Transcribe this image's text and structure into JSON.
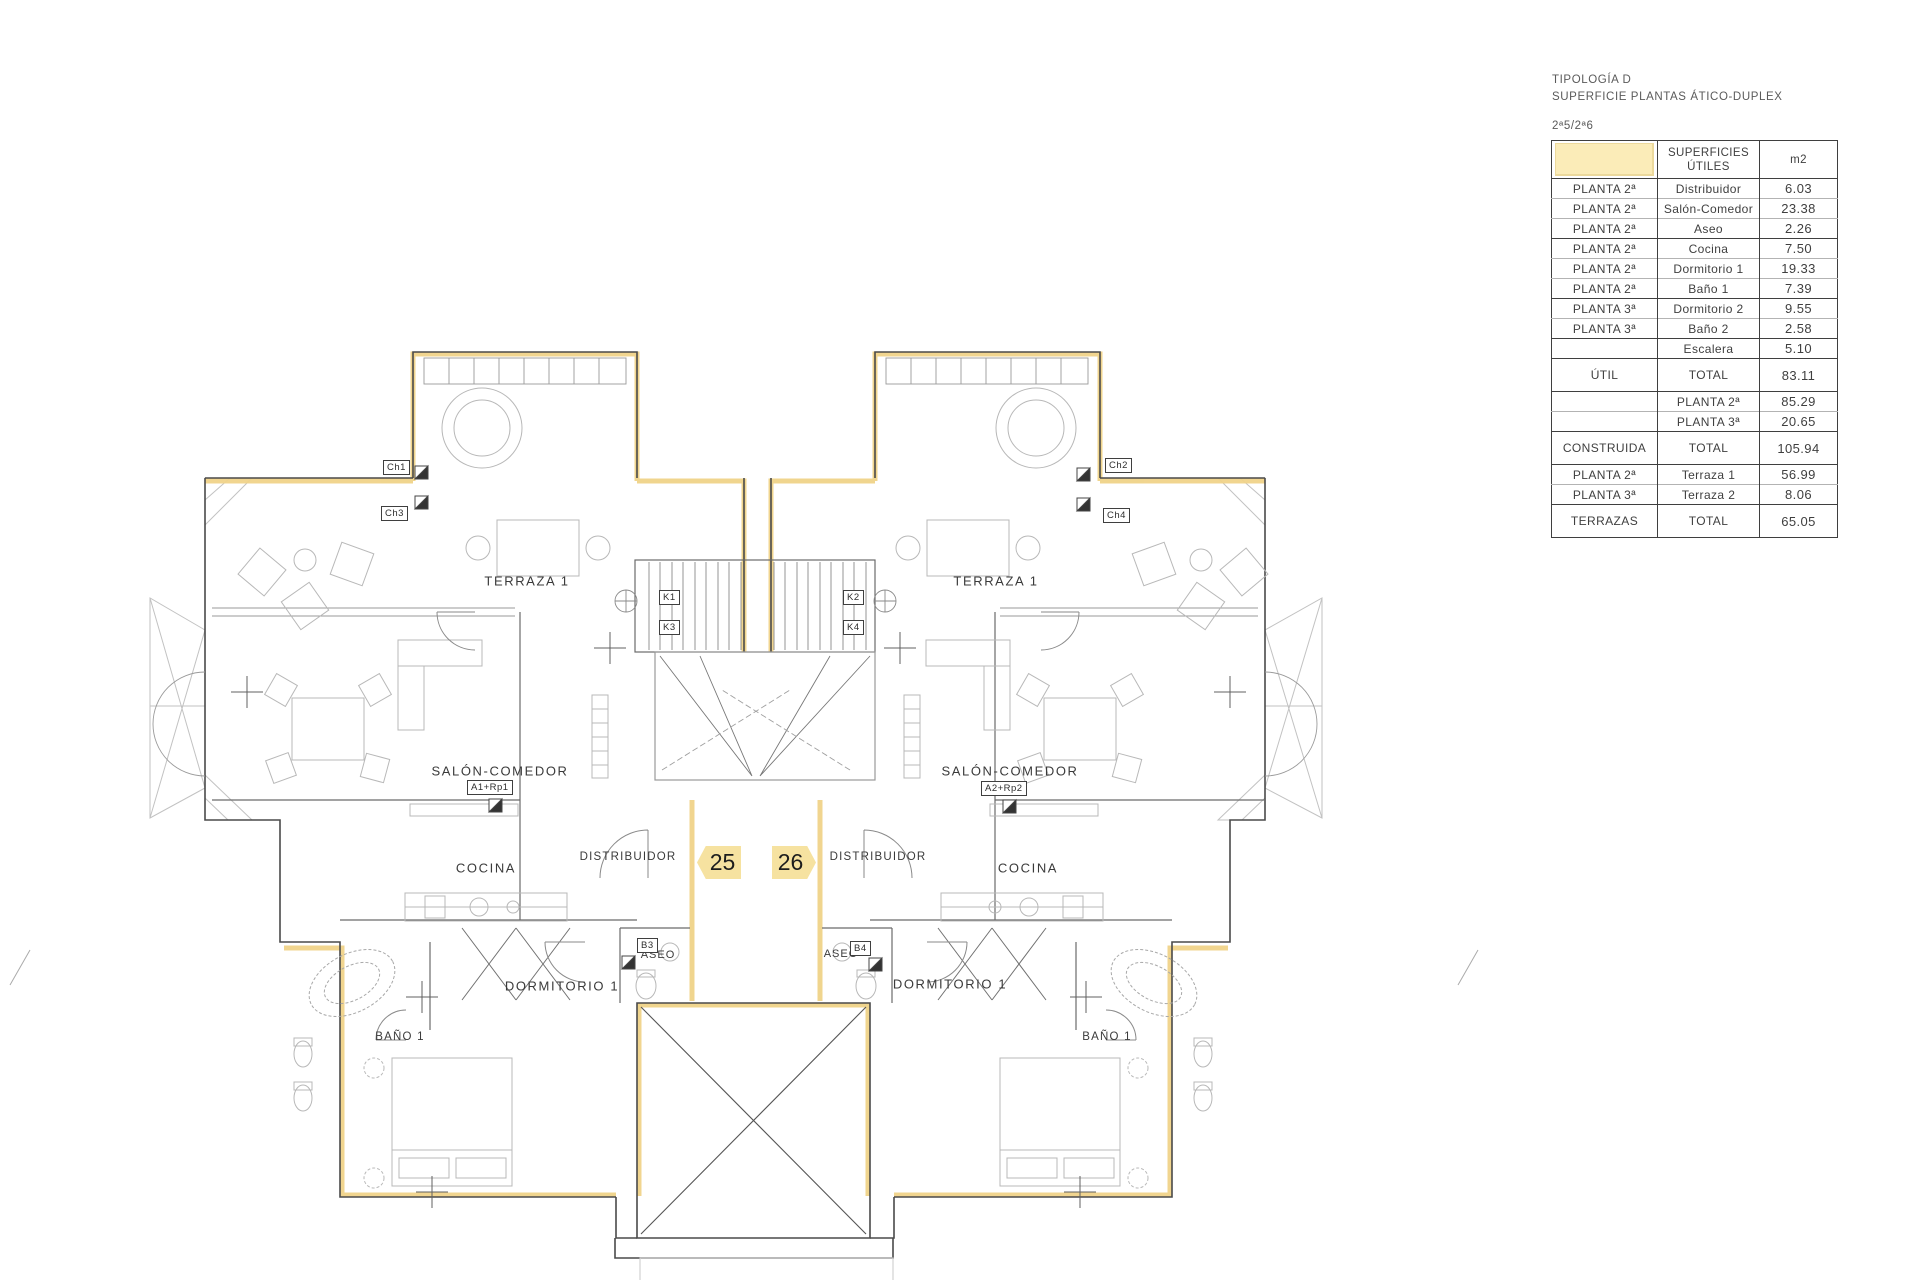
{
  "title_block": {
    "line1": "TIPOLOGÍA D",
    "line2": "SUPERFICIE PLANTAS ÁTICO-DUPLEX",
    "units": "2ª5/2ª6"
  },
  "table": {
    "header": {
      "col2_line1": "SUPERFICIES",
      "col2_line2": "ÚTILES",
      "col3": "m2"
    },
    "rows": [
      {
        "zone": "PLANTA 2ª",
        "room": "Distribuidor",
        "value": "6.03",
        "tall": false,
        "group_end": false
      },
      {
        "zone": "PLANTA 2ª",
        "room": "Salón-Comedor",
        "value": "23.38",
        "tall": false,
        "group_end": false
      },
      {
        "zone": "PLANTA 2ª",
        "room": "Aseo",
        "value": "2.26",
        "tall": false,
        "group_end": true
      },
      {
        "zone": "PLANTA 2ª",
        "room": "Cocina",
        "value": "7.50",
        "tall": false,
        "group_end": false
      },
      {
        "zone": "PLANTA 2ª",
        "room": "Dormitorio 1",
        "value": "19.33",
        "tall": false,
        "group_end": false
      },
      {
        "zone": "PLANTA 2ª",
        "room": "Baño 1",
        "value": "7.39",
        "tall": false,
        "group_end": true
      },
      {
        "zone": "PLANTA 3ª",
        "room": "Dormitorio 2",
        "value": "9.55",
        "tall": false,
        "group_end": false
      },
      {
        "zone": "PLANTA 3ª",
        "room": "Baño 2",
        "value": "2.58",
        "tall": false,
        "group_end": true
      },
      {
        "zone": "",
        "room": "Escalera",
        "value": "5.10",
        "tall": false,
        "group_end": true
      },
      {
        "zone": "ÚTIL",
        "room": "TOTAL",
        "value": "83.11",
        "tall": true,
        "group_end": true
      },
      {
        "zone": "",
        "room": "PLANTA 2ª",
        "value": "85.29",
        "tall": false,
        "group_end": false
      },
      {
        "zone": "",
        "room": "PLANTA 3ª",
        "value": "20.65",
        "tall": false,
        "group_end": true
      },
      {
        "zone": "CONSTRUIDA",
        "room": "TOTAL",
        "value": "105.94",
        "tall": true,
        "group_end": true
      },
      {
        "zone": "PLANTA 2ª",
        "room": "Terraza 1",
        "value": "56.99",
        "tall": false,
        "group_end": false
      },
      {
        "zone": "PLANTA 3ª",
        "room": "Terraza 2",
        "value": "8.06",
        "tall": false,
        "group_end": true
      },
      {
        "zone": "TERRAZAS",
        "room": "TOTAL",
        "value": "65.05",
        "tall": true,
        "group_end": false
      }
    ]
  },
  "plan": {
    "colors": {
      "highlight": "#f0d389",
      "badgeFill": "#f6e2a0",
      "badgeBorder": "#e6c želé"
    },
    "badges": {
      "left": "25",
      "right": "26"
    },
    "rooms": {
      "terraza": "TERRAZA 1",
      "salon": "SALÓN-COMEDOR",
      "cocina": "COCINA",
      "distribuidor": "DISTRIBUIDOR",
      "dormitorio": "DORMITORIO 1",
      "bano": "BAÑO 1",
      "aseo": "ASEO"
    },
    "tags": {
      "ch1": "Ch1",
      "ch2": "Ch2",
      "ch3": "Ch3",
      "ch4": "Ch4",
      "k1": "K1",
      "k2": "K2",
      "k3": "K3",
      "k4": "K4",
      "a1": "A1+Rp1",
      "a2": "A2+Rp2",
      "b3": "B3",
      "b4": "B4"
    }
  }
}
